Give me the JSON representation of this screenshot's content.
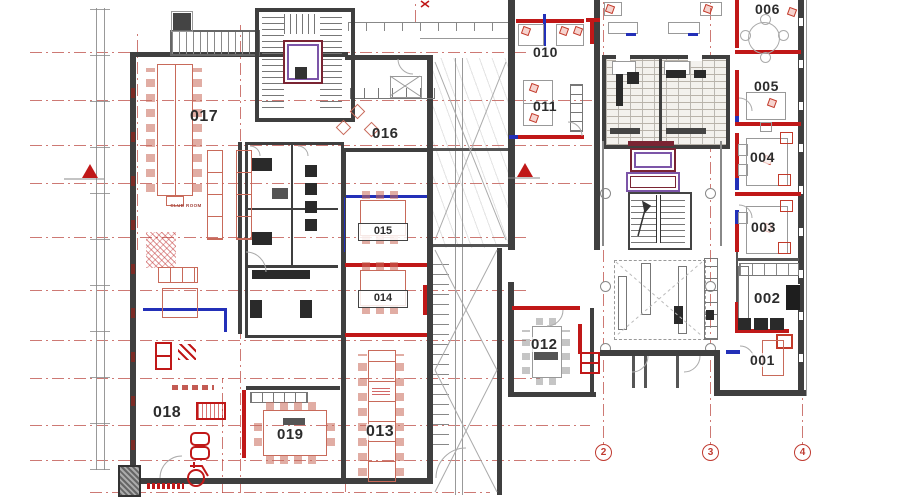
{
  "rooms": {
    "r001": {
      "label": "001"
    },
    "r002": {
      "label": "002"
    },
    "r003": {
      "label": "003"
    },
    "r004": {
      "label": "004"
    },
    "r005": {
      "label": "005"
    },
    "r006": {
      "label": "006"
    },
    "r010": {
      "label": "010"
    },
    "r011": {
      "label": "011"
    },
    "r012": {
      "label": "012"
    },
    "r013": {
      "label": "013"
    },
    "r014": {
      "label": "014"
    },
    "r015": {
      "label": "015"
    },
    "r016": {
      "label": "016"
    },
    "r017": {
      "label": "017"
    },
    "r018": {
      "label": "018"
    },
    "r019": {
      "label": "019"
    }
  },
  "grid": {
    "bubbles": [
      "2",
      "3",
      "4"
    ]
  },
  "annotations": {
    "club_room": "CLUB ROOM"
  },
  "colors": {
    "wall": "#3f3f3f",
    "accent_red": "#c01818",
    "furniture_red": "#c86a5a",
    "accent_blue": "#2330b8",
    "grid_red": "#b84038",
    "elevator_purple": "#7c55a8",
    "elevator_maroon": "#7a2433"
  }
}
